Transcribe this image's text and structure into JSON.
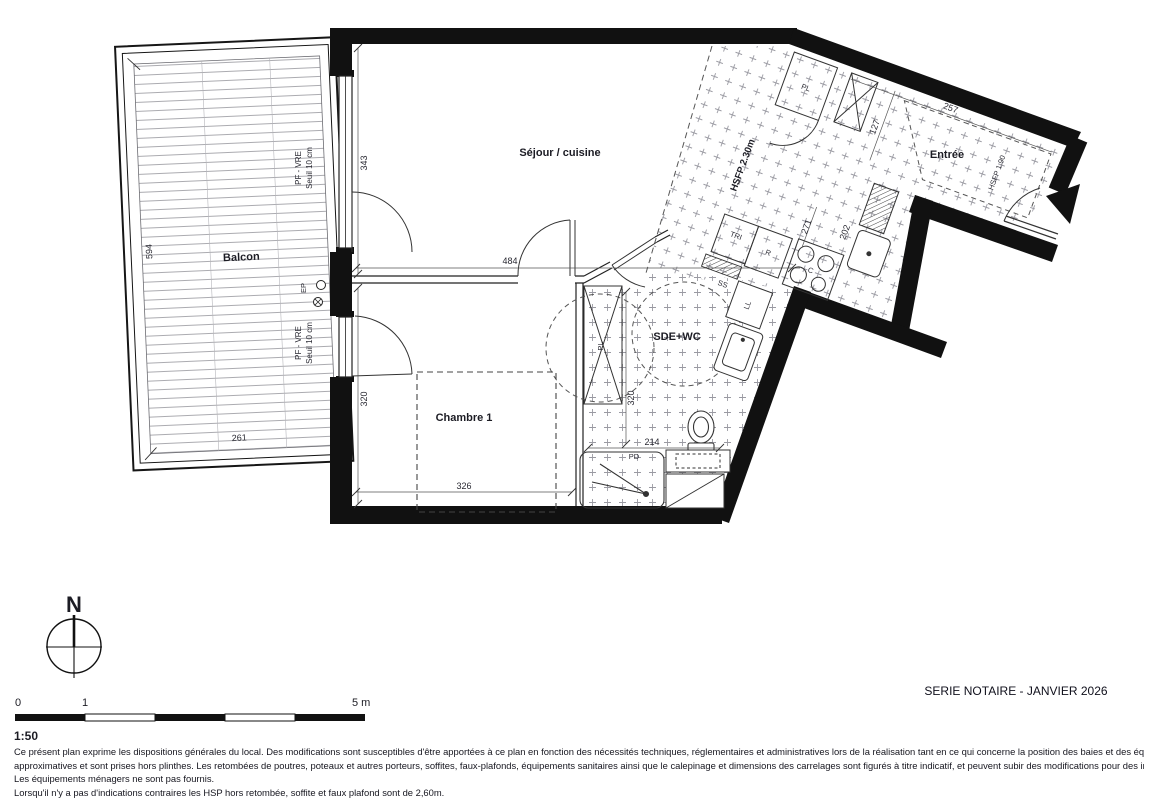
{
  "plan": {
    "room_labels": {
      "balcon": "Balcon",
      "sejour": "Séjour / cuisine",
      "entree": "Entrée",
      "chambre": "Chambre 1",
      "sde": "SDE+WC"
    },
    "window_labels": {
      "pf_vre_1": "PF - VRE",
      "seuil_1": "Seuil 10 cm",
      "pf_vre_2": "PF - VRE",
      "seuil_2": "Seuil 10 cm"
    },
    "annotations": {
      "ep": "EP",
      "hsfp_kitchen": "HSFP 2.30m",
      "hsfp_entry": "HSFP 1.90",
      "tri": "TRI",
      "fridge": "R",
      "cooktop": "C",
      "towel_rail": "SS",
      "washing_machine": "LL",
      "closet_entree": "PL",
      "closet_chambre": "PL",
      "shower_door": "PD"
    },
    "dimensions": {
      "sejour_height": "343",
      "sejour_width": "484",
      "chambre_height": "320",
      "chambre_width": "326",
      "balcon_height": "594",
      "balcon_width": "261",
      "sde_height": "320",
      "sde_width": "214",
      "kitchen_counter": "271",
      "kitchen_depth": "202",
      "entree_width": "127",
      "entree_length": "257"
    }
  },
  "compass": {
    "north_label": "N"
  },
  "scale_bar": {
    "tick_0": "0",
    "tick_1": "1",
    "tick_5": "5 m",
    "ratio": "1:50"
  },
  "title_block": {
    "series_title": "SERIE NOTAIRE - JANVIER 2026"
  },
  "legal": {
    "lines": [
      "Ce présent plan exprime les dispositions générales du local. Des modifications sont susceptibles d'être apportées à ce plan en fonction des nécessités techniques, réglementaires et administratives lors de la réalisation tant en ce qui concerne la position des baies et des équipements. Les surfaces sont",
      "approximatives et sont prises hors plinthes. Les retombées de poutres, poteaux et autres porteurs, soffites, faux-plafonds, équipements sanitaires ainsi que le calepinage et dimensions des carrelages sont figurés à titre indicatif, et peuvent subir des modifications pour des impératifs techniques.",
      "Les équipements ménagers ne sont pas fournis.",
      "Lorsqu'il n'y a pas d'indications contraires les HSP hors retombée, soffite et faux plafond sont de 2,60m.",
      "Le descriptif sommaire complète ce plan pour les matériaux et équipements fournis"
    ]
  }
}
